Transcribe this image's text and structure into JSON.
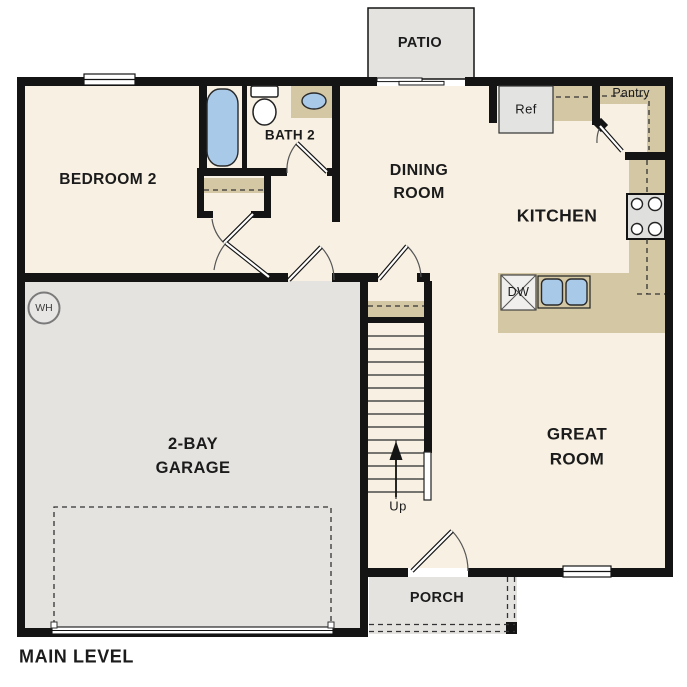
{
  "title": "MAIN LEVEL",
  "colors": {
    "floor": "#F7F0E3",
    "outdoor": "#E4E3E0",
    "counter": "#D4C7A4",
    "fixture": "#A9C9E9",
    "wall": "#141414",
    "appliance": "#E3E3E2",
    "text": "#1B1B1B"
  },
  "rooms": {
    "bedroom2": {
      "label": "BEDROOM 2"
    },
    "bath2": {
      "label": "BATH 2"
    },
    "dining": {
      "line1": "DINING",
      "line2": "ROOM"
    },
    "kitchen": {
      "label": "KITCHEN"
    },
    "great": {
      "line1": "GREAT",
      "line2": "ROOM"
    },
    "garage": {
      "line1": "2-BAY",
      "line2": "GARAGE"
    },
    "patio": {
      "label": "PATIO"
    },
    "porch": {
      "label": "PORCH"
    }
  },
  "fixtures": {
    "pantry": "Pantry",
    "fridge": "Ref",
    "dishwasher": "DW",
    "water_heater": "WH",
    "stairs_direction": "Up"
  }
}
